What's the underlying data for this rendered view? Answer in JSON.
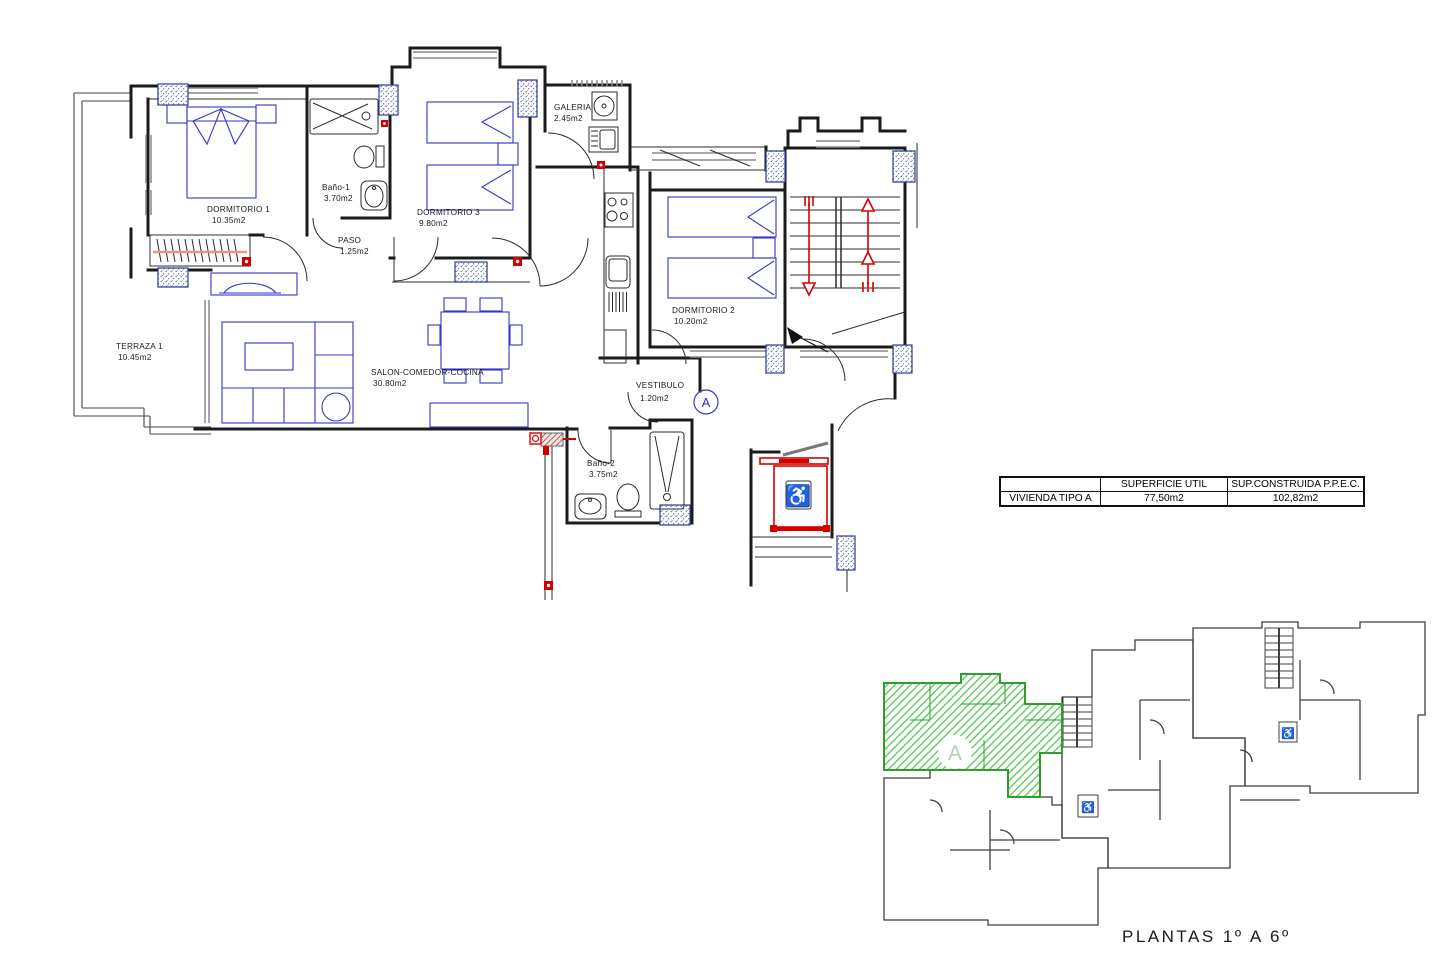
{
  "plan": {
    "unit_marker": "A",
    "rooms": [
      {
        "name": "DORMITORIO 1",
        "area": "10.35m2"
      },
      {
        "name": "Baño-1",
        "area": "3.70m2"
      },
      {
        "name": "DORMITORIO 3",
        "area": "9.80m2"
      },
      {
        "name": "PASO",
        "area": "1.25m2"
      },
      {
        "name": "GALERIA",
        "area": "2.45m2"
      },
      {
        "name": "DORMITORIO 2",
        "area": "10.20m2"
      },
      {
        "name": "TERRAZA 1",
        "area": "10.45m2"
      },
      {
        "name": "SALON-COMEDOR-COCINA",
        "area": "30.80m2"
      },
      {
        "name": "VESTIBULO",
        "area": "1.20m2"
      },
      {
        "name": "Baño-2",
        "area": "3.75m2"
      }
    ]
  },
  "summary_table": {
    "columns": [
      "",
      "SUPERFICIE UTIL",
      "SUP.CONSTRUIDA P.P.E.C."
    ],
    "row": {
      "label": "VIVIENDA TIPO A",
      "util": "77,50m2",
      "construida": "102,82m2"
    }
  },
  "overview": {
    "caption": "PLANTAS 1º A 6º",
    "highlight_label": "A"
  },
  "colors": {
    "wall_black": "#1b1b1b",
    "furniture_blue": "#3636c8",
    "accent_red": "#d40000",
    "highlight_green": "#55c855",
    "window_gray": "#8a8a8a",
    "pillar_blue": "#2a3a99",
    "wardrobe_rail_pink": "#f0908a"
  }
}
